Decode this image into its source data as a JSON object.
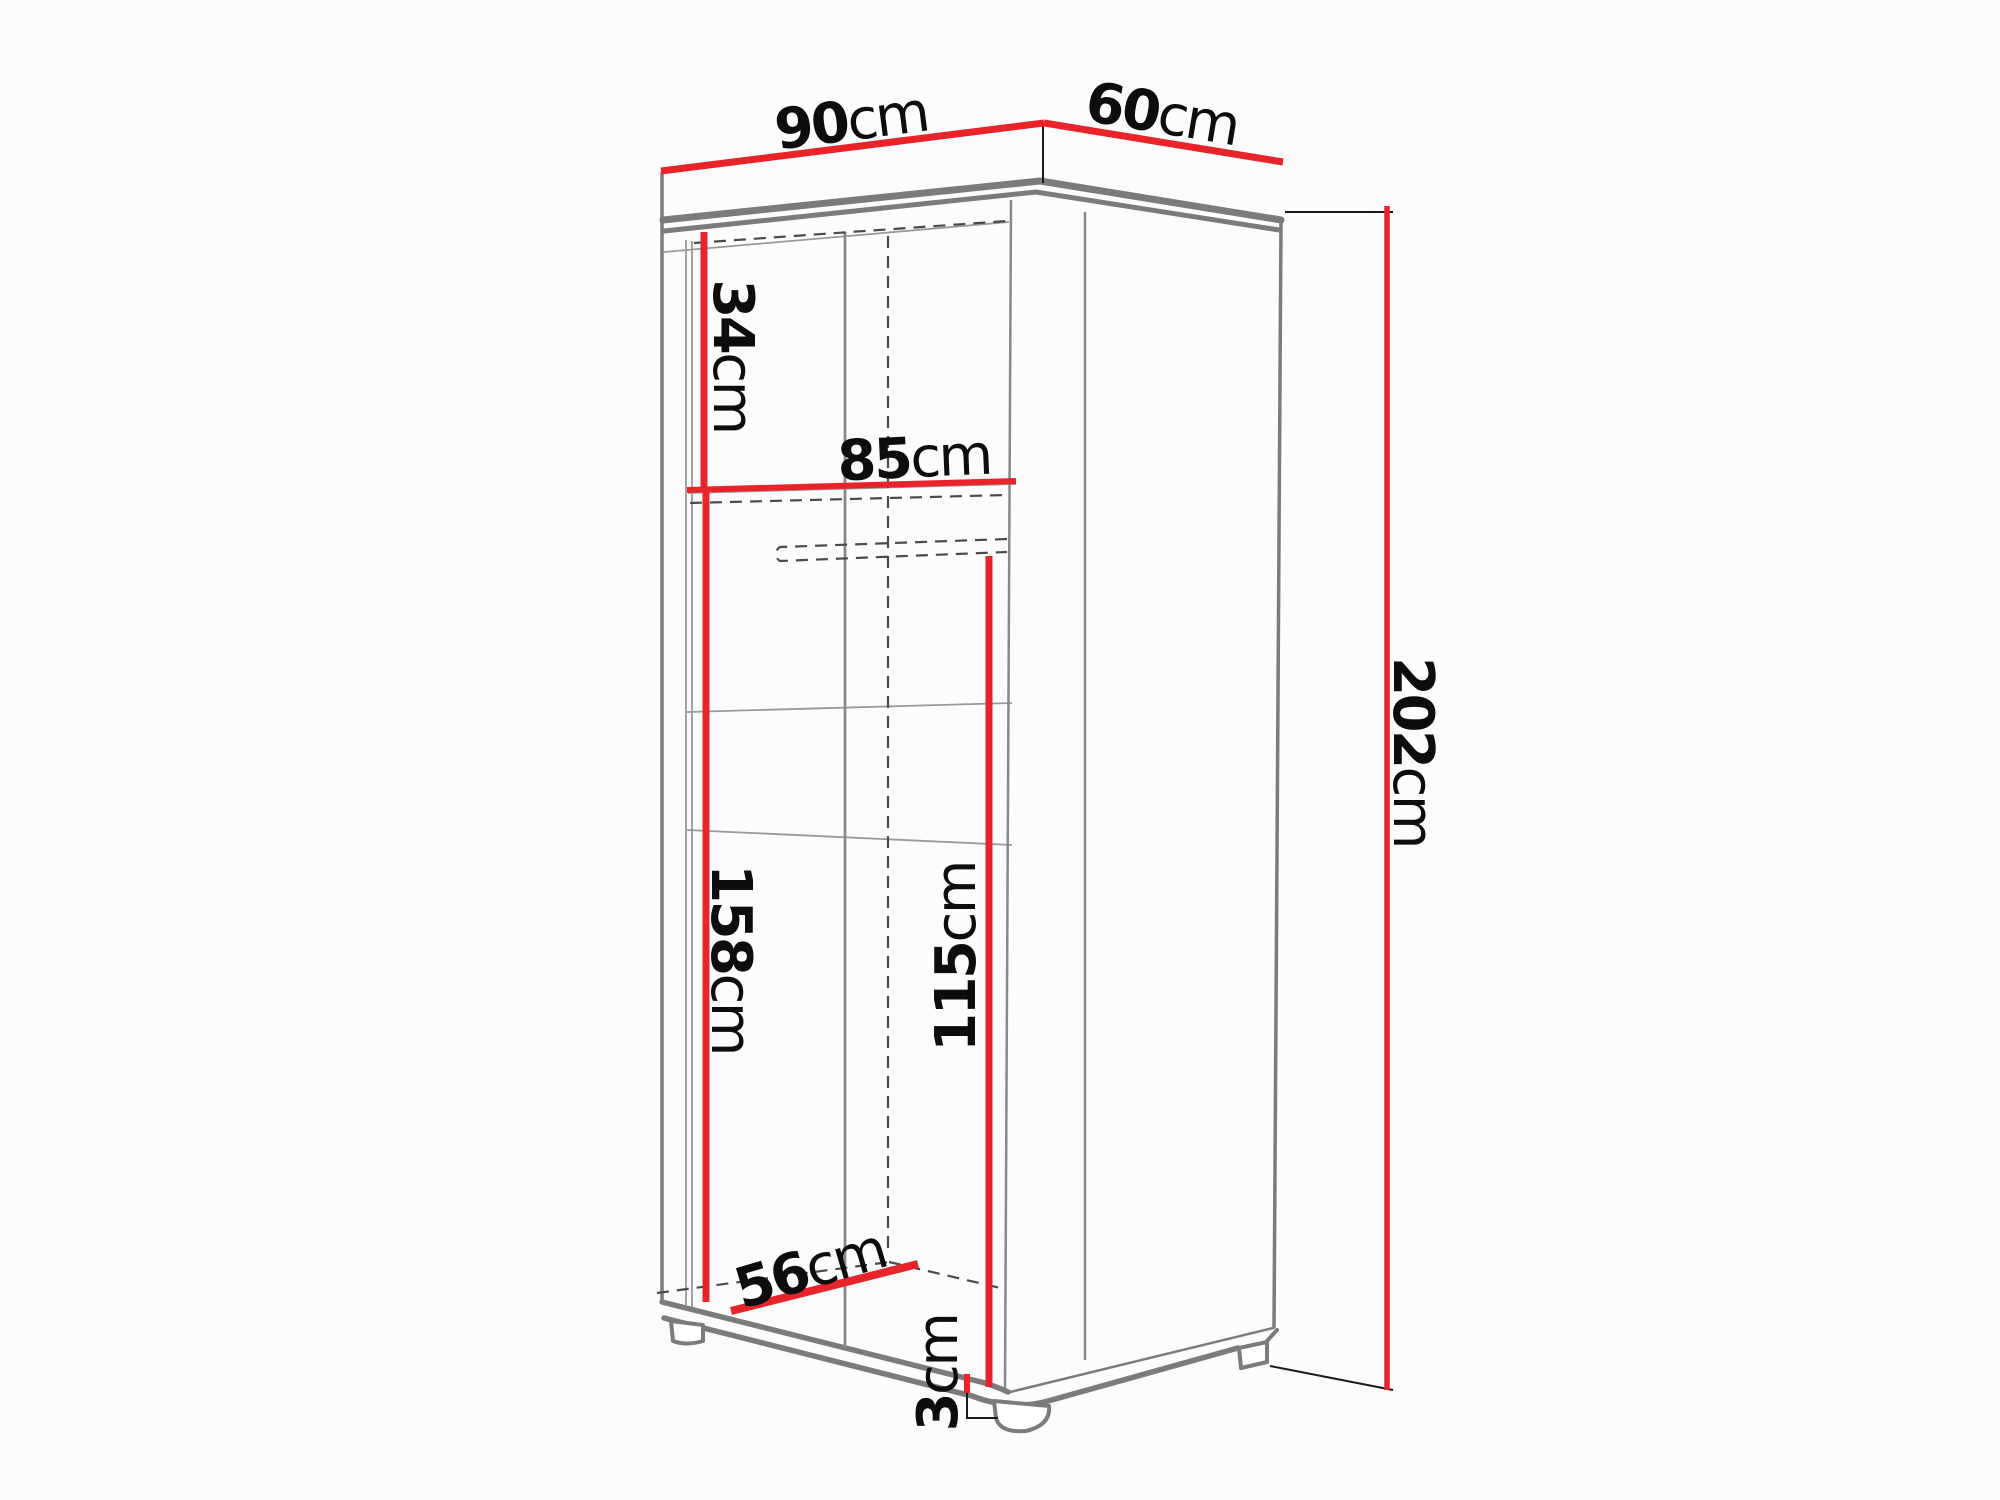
{
  "title": "Wardrobe technical dimension diagram",
  "colors": {
    "background": "#fcfcfc",
    "dimension_red": "#e8232a",
    "outline_gray": "#7b7b7b",
    "thin_gray": "#999999",
    "hidden_dash": "#4a4a4a",
    "extension_black": "#1a1a1a",
    "label_black": "#0d0d0d"
  },
  "dims": {
    "width": {
      "value": "90",
      "unit": "cm"
    },
    "depth": {
      "value": "60",
      "unit": "cm"
    },
    "height": {
      "value": "202",
      "unit": "cm"
    },
    "top_shelf_height": {
      "value": "34",
      "unit": "cm"
    },
    "interior_width": {
      "value": "85",
      "unit": "cm"
    },
    "interior_height": {
      "value": "158",
      "unit": "cm"
    },
    "hanging_height": {
      "value": "115",
      "unit": "cm"
    },
    "interior_depth": {
      "value": "56",
      "unit": "cm"
    },
    "leg_height": {
      "value": "3",
      "unit": "cm"
    }
  }
}
